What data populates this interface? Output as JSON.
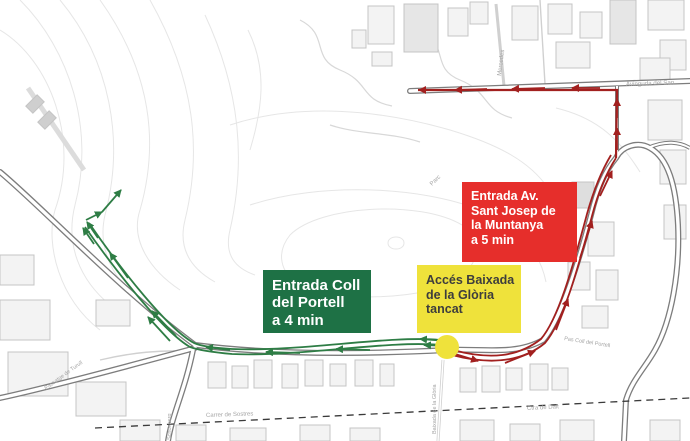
{
  "callouts": {
    "green_entrance": {
      "line1": "Entrada Coll",
      "line2": "del Portell",
      "line3": "a 4 min"
    },
    "red_entrance": {
      "line1": "Entrada Av.",
      "line2": "Sant Josep de",
      "line3": "la Muntanya",
      "line4": "a 5 min"
    },
    "closed_access": {
      "line1": "Accés Baixada",
      "line2": "de la Glòria",
      "line3": "tancat"
    }
  },
  "streets": {
    "avinguda": "Avinguda del San",
    "mercedes": "Mercedes",
    "parc": "Parc",
    "pas_coll_portell": "Pas Coll del Portell",
    "carrer_sostres": "Carrer de Sostres",
    "ctra_dalt": "Ctra de Dalt",
    "baixada_gloria": "Baixada de la Glòria",
    "schonberg": "Schonberg",
    "passatge_turull": "Passatge de Turull"
  },
  "colors": {
    "green_box": "#1e7145",
    "red_box": "#e62e2b",
    "yellow_box": "#efe23b",
    "green_route": "#2e7d45",
    "red_route": "#a2201f",
    "closed_point": "#efe23b"
  }
}
